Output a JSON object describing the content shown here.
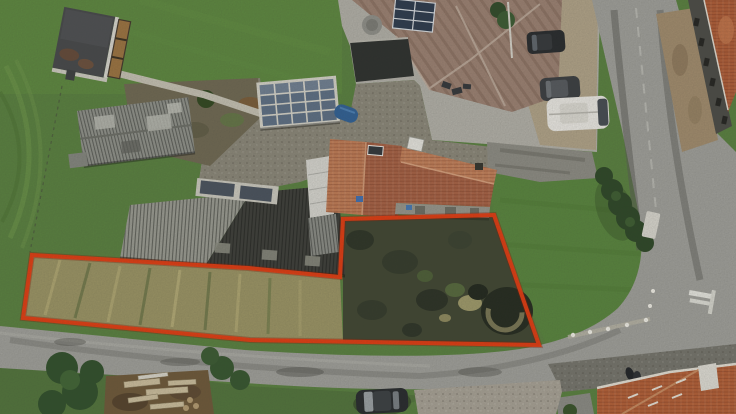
{
  "scene": {
    "kind": "aerial-drone-photograph",
    "description": "Overhead drone photo of a rural building plot outlined in red, with an old grey barn, a house with an orange tiled roof, neighbouring houses with solar panels, green lawns, a country road junction, parked cars and a white camper van.",
    "boundary": {
      "label": "plot-boundary-outline",
      "color": "#e63b10",
      "halo_color": "#8a1e05",
      "stroke_width": 4,
      "points": "32,255 248,268 340,277 343,219 494,215 539,345 250,340 23,318"
    },
    "colors": {
      "grass": "#59813f",
      "lawn_bright": "#619140",
      "dried_grass": "#9b9464",
      "plot_scrub": "#3f4531",
      "road": "#a0a09b",
      "gravel_courtyard": "#8b8779",
      "paving_light": "#b3b1a9",
      "parking_tan": "#b2a489",
      "dirt_garden": "#6f6852",
      "barn_light": "#9b9c93",
      "barn_dark": "#3c3d38",
      "old_barn": "#90928b",
      "shed_roof": "#46484a",
      "wood_panels": "#9c7340",
      "house_roof": "#c27c55",
      "house_roof_dark": "#a86144",
      "neighbor_roof": "#9c8172",
      "solar_panel": "#5d6f85",
      "solar_dark": "#2c3a4d",
      "orange_roof_right": "#b05c36",
      "orange_roof_bottom": "#b55f36",
      "hedge": "#2c4626",
      "pond": "#23291e",
      "camper": "#eceae5",
      "car_dark": "#26292c",
      "cobbles": "#75746c",
      "wood_pile": "#6e5838",
      "barrel_blue": "#2f6096"
    },
    "features": [
      "red plot boundary outline",
      "grey corrugated barn",
      "old grey shed barn",
      "orange tiled farmhouse",
      "neighbour house with solar panels",
      "flat garage roof covered with solar panels",
      "garden shed with wooden panels",
      "overgrown plot with pond",
      "country road junction",
      "white camper van",
      "three parked dark cars",
      "wood pile and trees",
      "hedge row and white bench",
      "orange roofs of buildings across the road"
    ]
  }
}
